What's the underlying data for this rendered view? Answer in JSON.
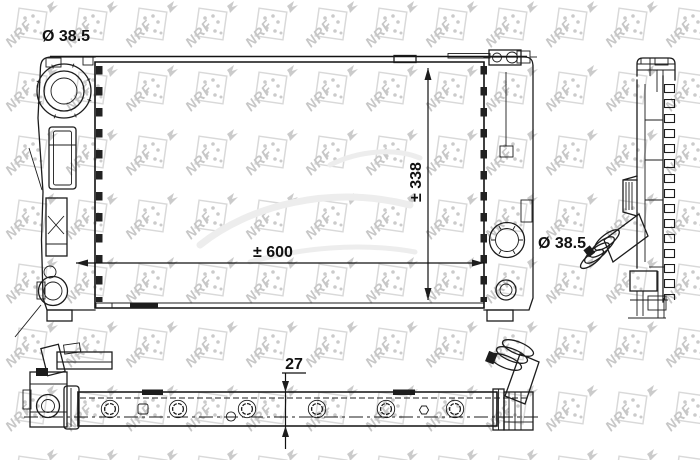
{
  "drawing": {
    "watermark": "NRF",
    "labels": {
      "cap_diameter": "Ø 38.5",
      "hose_diameter": "Ø 38.5",
      "width": "± 600",
      "height": "± 338",
      "thickness": "27"
    },
    "colors": {
      "line": "#1c1c1c",
      "watermark": "#cccccc",
      "background": "#ffffff"
    }
  }
}
